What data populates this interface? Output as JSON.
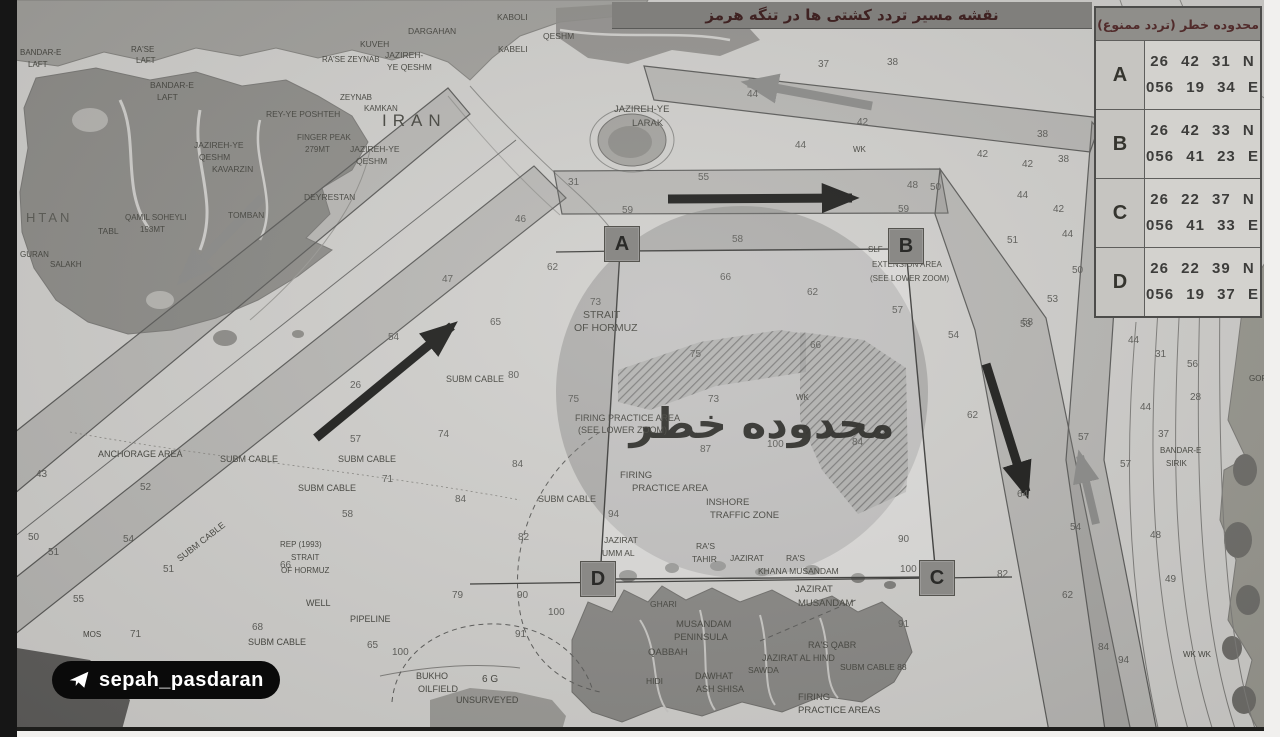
{
  "title": {
    "text": "نقشه مسیر تردد کشتی ها در تنگه هرمز"
  },
  "coords_table": {
    "header": "محدوده خطر (تردد ممنوع)",
    "rows": [
      {
        "point": "A",
        "lat": "26 42 31 N",
        "lon": "056 19 34 E"
      },
      {
        "point": "B",
        "lat": "26 42 33 N",
        "lon": "056 41 23 E"
      },
      {
        "point": "C",
        "lat": "26 22 37 N",
        "lon": "056 41 33 E"
      },
      {
        "point": "D",
        "lat": "26 22 39 N",
        "lon": "056 19 37 E"
      }
    ]
  },
  "watermark": {
    "label": "sepah_pasdaran",
    "icon": "telegram-plane-icon"
  },
  "map": {
    "danger_zone_label": "محدوده خطر",
    "corner_markers": [
      "A",
      "B",
      "C",
      "D"
    ],
    "arrows": [
      "inbound-northeast-arrow-black",
      "outbound-southwest-arrow-gray",
      "eastbound-arrow-black",
      "westbound-arrow-gray",
      "southbound-arrow-black",
      "northbound-arrow-gray"
    ],
    "colors": {
      "paper": "#cfcecb",
      "land_dark": "#8d8c88",
      "land_mid": "#a09f9b",
      "coast_right": "#98978f",
      "lane_line": "#5a5a58",
      "danger_fill": "#787876",
      "hatch": "#3f3f3d",
      "marker_bg": "#8a8986",
      "title_bar_bg": "#807f7c",
      "title_text": "#3f2222",
      "table_header_bg": "#8f8e8a",
      "table_text": "#3d3d3b",
      "watermark_bg": "#0a0a0a",
      "watermark_text": "#ffffff"
    },
    "place_labels": [
      {
        "t": "KABOLI",
        "x": 497,
        "y": 20,
        "fs": 8.5
      },
      {
        "t": "QESHM",
        "x": 543,
        "y": 39,
        "fs": 8.5
      },
      {
        "t": "KABELI",
        "x": 498,
        "y": 52,
        "fs": 8.5
      },
      {
        "t": "DARGAHAN",
        "x": 408,
        "y": 34,
        "fs": 8.5
      },
      {
        "t": "KUVEH",
        "x": 360,
        "y": 47,
        "fs": 8.5
      },
      {
        "t": "RA'SE ZEYNAB",
        "x": 322,
        "y": 62,
        "fs": 8
      },
      {
        "t": "JAZIREH-",
        "x": 385,
        "y": 58,
        "fs": 8.5
      },
      {
        "t": "YE QESHM",
        "x": 387,
        "y": 70,
        "fs": 8.5
      },
      {
        "t": "ZEYNAB",
        "x": 340,
        "y": 100,
        "fs": 8
      },
      {
        "t": "KAMKAN",
        "x": 364,
        "y": 111,
        "fs": 8
      },
      {
        "t": "REY-YE POSHTEH",
        "x": 266,
        "y": 117,
        "fs": 8.5
      },
      {
        "t": "RA'SE",
        "x": 131,
        "y": 52,
        "fs": 8
      },
      {
        "t": "LAFT",
        "x": 136,
        "y": 63,
        "fs": 8
      },
      {
        "t": "BANDAR-E",
        "x": 20,
        "y": 55,
        "fs": 8
      },
      {
        "t": "LAFT",
        "x": 28,
        "y": 67,
        "fs": 8
      },
      {
        "t": "BANDAR-E",
        "x": 150,
        "y": 88,
        "fs": 8.5
      },
      {
        "t": "LAFT",
        "x": 157,
        "y": 100,
        "fs": 8.5
      },
      {
        "t": "JAZIREH-YE",
        "x": 194,
        "y": 148,
        "fs": 8.5
      },
      {
        "t": "QESHM",
        "x": 199,
        "y": 160,
        "fs": 8.5
      },
      {
        "t": "KAVARZIN",
        "x": 212,
        "y": 172,
        "fs": 8.5
      },
      {
        "t": "FINGER PEAK",
        "x": 297,
        "y": 140,
        "fs": 8
      },
      {
        "t": "279MT",
        "x": 305,
        "y": 152,
        "fs": 8
      },
      {
        "t": "IRAN",
        "x": 382,
        "y": 126,
        "fs": 17,
        "ls": 6
      },
      {
        "t": "JAZIREH-YE",
        "x": 350,
        "y": 152,
        "fs": 8.5
      },
      {
        "t": "QESHM",
        "x": 356,
        "y": 164,
        "fs": 8.5
      },
      {
        "t": "DEYRESTAN",
        "x": 304,
        "y": 200,
        "fs": 8.5
      },
      {
        "t": "QAMIL SOHEYLI",
        "x": 125,
        "y": 220,
        "fs": 8
      },
      {
        "t": "198MT",
        "x": 140,
        "y": 232,
        "fs": 8
      },
      {
        "t": "TOMBAN",
        "x": 228,
        "y": 218,
        "fs": 8.5
      },
      {
        "t": "TABL",
        "x": 98,
        "y": 234,
        "fs": 8.5
      },
      {
        "t": "HTAN",
        "x": 26,
        "y": 222,
        "fs": 13,
        "ls": 3,
        "o": 0.7
      },
      {
        "t": "GURAN",
        "x": 20,
        "y": 257,
        "fs": 8
      },
      {
        "t": "SALAKH",
        "x": 50,
        "y": 267,
        "fs": 8
      },
      {
        "t": "JAZIREH-YE",
        "x": 614,
        "y": 112,
        "fs": 9.5
      },
      {
        "t": "LARAK",
        "x": 632,
        "y": 126,
        "fs": 9.5
      },
      {
        "t": "STRAIT",
        "x": 583,
        "y": 318,
        "fs": 10.5
      },
      {
        "t": "OF HORMUZ",
        "x": 574,
        "y": 331,
        "fs": 10.5
      },
      {
        "t": "SUBM CABLE",
        "x": 446,
        "y": 382,
        "fs": 9
      },
      {
        "t": "SUBM CABLE",
        "x": 220,
        "y": 462,
        "fs": 9
      },
      {
        "t": "SUBM CABLE",
        "x": 338,
        "y": 462,
        "fs": 9
      },
      {
        "t": "SUBM CABLE",
        "x": 298,
        "y": 491,
        "fs": 9
      },
      {
        "t": "SUBM CABLE",
        "x": 180,
        "y": 562,
        "fs": 9,
        "rot": -38
      },
      {
        "t": "SUBM CABLE",
        "x": 538,
        "y": 502,
        "fs": 9
      },
      {
        "t": "SUBM CABLE",
        "x": 248,
        "y": 645,
        "fs": 9
      },
      {
        "t": "ANCHORAGE AREA",
        "x": 98,
        "y": 457,
        "fs": 9
      },
      {
        "t": "REP (1993)",
        "x": 280,
        "y": 547,
        "fs": 8
      },
      {
        "t": "STRAIT",
        "x": 291,
        "y": 560,
        "fs": 8
      },
      {
        "t": "OF HORMUZ",
        "x": 281,
        "y": 573,
        "fs": 8
      },
      {
        "t": "WELL",
        "x": 306,
        "y": 606,
        "fs": 9
      },
      {
        "t": "PIPELINE",
        "x": 350,
        "y": 622,
        "fs": 9
      },
      {
        "t": "BUKHO",
        "x": 416,
        "y": 679,
        "fs": 9
      },
      {
        "t": "OILFIELD",
        "x": 418,
        "y": 692,
        "fs": 9
      },
      {
        "t": "6 G",
        "x": 482,
        "y": 682,
        "fs": 10
      },
      {
        "t": "UNSURVEYED",
        "x": 456,
        "y": 703,
        "fs": 9
      },
      {
        "t": "FIRING PRACTICE AREA",
        "x": 575,
        "y": 421,
        "fs": 9
      },
      {
        "t": "(SEE LOWER ZOOM)",
        "x": 578,
        "y": 433,
        "fs": 9
      },
      {
        "t": "FIRING",
        "x": 620,
        "y": 478,
        "fs": 9.5
      },
      {
        "t": "PRACTICE AREA",
        "x": 632,
        "y": 491,
        "fs": 9.5
      },
      {
        "t": "INSHORE",
        "x": 706,
        "y": 505,
        "fs": 9.5
      },
      {
        "t": "TRAFFIC ZONE",
        "x": 710,
        "y": 518,
        "fs": 9.5
      },
      {
        "t": "JAZIRAT",
        "x": 604,
        "y": 543,
        "fs": 8.5
      },
      {
        "t": "UMM AL",
        "x": 602,
        "y": 556,
        "fs": 8.5
      },
      {
        "t": "RA'S",
        "x": 696,
        "y": 549,
        "fs": 8.5
      },
      {
        "t": "TAHIR",
        "x": 692,
        "y": 562,
        "fs": 8.5
      },
      {
        "t": "JAZIRAT",
        "x": 730,
        "y": 561,
        "fs": 8.5
      },
      {
        "t": "RA'S",
        "x": 786,
        "y": 561,
        "fs": 8.5
      },
      {
        "t": "KHANA MUSANDAM",
        "x": 758,
        "y": 574,
        "fs": 8.5
      },
      {
        "t": "JAZIRAT",
        "x": 795,
        "y": 592,
        "fs": 9.5
      },
      {
        "t": "MUSANDAM",
        "x": 798,
        "y": 606,
        "fs": 9.5
      },
      {
        "t": "GHARI",
        "x": 650,
        "y": 607,
        "fs": 8.5
      },
      {
        "t": "MUSANDAM",
        "x": 676,
        "y": 627,
        "fs": 9.5
      },
      {
        "t": "PENINSULA",
        "x": 674,
        "y": 640,
        "fs": 9.5
      },
      {
        "t": "QABBAH",
        "x": 648,
        "y": 655,
        "fs": 9.5
      },
      {
        "t": "RA'S QABR",
        "x": 808,
        "y": 648,
        "fs": 9
      },
      {
        "t": "JAZIRAT AL HIND",
        "x": 762,
        "y": 661,
        "fs": 9
      },
      {
        "t": "SAWDA",
        "x": 748,
        "y": 673,
        "fs": 8.5
      },
      {
        "t": "DAWHAT",
        "x": 695,
        "y": 679,
        "fs": 9
      },
      {
        "t": "ASH SHISA",
        "x": 696,
        "y": 692,
        "fs": 9
      },
      {
        "t": "HIDI",
        "x": 646,
        "y": 684,
        "fs": 8.5
      },
      {
        "t": "SUBM CABLE 88",
        "x": 840,
        "y": 670,
        "fs": 8.5
      },
      {
        "t": "FIRING",
        "x": 798,
        "y": 700,
        "fs": 9.5
      },
      {
        "t": "PRACTICE AREAS",
        "x": 798,
        "y": 713,
        "fs": 9.5
      },
      {
        "t": "SLF",
        "x": 868,
        "y": 252,
        "fs": 8
      },
      {
        "t": "EXTENSION AREA",
        "x": 872,
        "y": 267,
        "fs": 8
      },
      {
        "t": "(SEE LOWER ZOOM)",
        "x": 870,
        "y": 281,
        "fs": 8
      },
      {
        "t": "BANDAR-E",
        "x": 1160,
        "y": 453,
        "fs": 8
      },
      {
        "t": "SIRIK",
        "x": 1166,
        "y": 466,
        "fs": 8
      },
      {
        "t": "GOR",
        "x": 1249,
        "y": 381,
        "fs": 8
      },
      {
        "t": "WK",
        "x": 853,
        "y": 152,
        "fs": 8
      },
      {
        "t": "WK",
        "x": 796,
        "y": 400,
        "fs": 8
      },
      {
        "t": "WK WK",
        "x": 1183,
        "y": 657,
        "fs": 8
      },
      {
        "t": "MOS",
        "x": 83,
        "y": 637,
        "fs": 8
      }
    ],
    "depth_labels": [
      {
        "t": "37",
        "x": 818,
        "y": 67
      },
      {
        "t": "38",
        "x": 887,
        "y": 65
      },
      {
        "t": "44",
        "x": 747,
        "y": 97
      },
      {
        "t": "42",
        "x": 857,
        "y": 125
      },
      {
        "t": "44",
        "x": 795,
        "y": 148
      },
      {
        "t": "42",
        "x": 977,
        "y": 157
      },
      {
        "t": "38",
        "x": 1037,
        "y": 137
      },
      {
        "t": "38",
        "x": 1058,
        "y": 162
      },
      {
        "t": "42",
        "x": 1022,
        "y": 167
      },
      {
        "t": "44",
        "x": 1017,
        "y": 198
      },
      {
        "t": "42",
        "x": 1053,
        "y": 212
      },
      {
        "t": "44",
        "x": 1062,
        "y": 237
      },
      {
        "t": "51",
        "x": 1007,
        "y": 243
      },
      {
        "t": "50",
        "x": 1072,
        "y": 273
      },
      {
        "t": "53",
        "x": 1047,
        "y": 302
      },
      {
        "t": "53",
        "x": 1020,
        "y": 327
      },
      {
        "t": "57",
        "x": 892,
        "y": 313
      },
      {
        "t": "54",
        "x": 948,
        "y": 338
      },
      {
        "t": "48",
        "x": 907,
        "y": 188
      },
      {
        "t": "50",
        "x": 930,
        "y": 190
      },
      {
        "t": "59",
        "x": 898,
        "y": 212
      },
      {
        "t": "55",
        "x": 698,
        "y": 180
      },
      {
        "t": "59",
        "x": 622,
        "y": 213
      },
      {
        "t": "58",
        "x": 732,
        "y": 242
      },
      {
        "t": "44",
        "x": 1128,
        "y": 343
      },
      {
        "t": "31",
        "x": 1155,
        "y": 357
      },
      {
        "t": "56",
        "x": 1187,
        "y": 367
      },
      {
        "t": "28",
        "x": 1190,
        "y": 400
      },
      {
        "t": "44",
        "x": 1140,
        "y": 410
      },
      {
        "t": "37",
        "x": 1158,
        "y": 437
      },
      {
        "t": "57",
        "x": 1078,
        "y": 440
      },
      {
        "t": "57",
        "x": 1120,
        "y": 467
      },
      {
        "t": "54",
        "x": 1070,
        "y": 530
      },
      {
        "t": "48",
        "x": 1150,
        "y": 538
      },
      {
        "t": "49",
        "x": 1165,
        "y": 582
      },
      {
        "t": "62",
        "x": 1062,
        "y": 598
      },
      {
        "t": "84",
        "x": 1098,
        "y": 650
      },
      {
        "t": "94",
        "x": 1118,
        "y": 663
      },
      {
        "t": "58",
        "x": 1022,
        "y": 325
      },
      {
        "t": "62",
        "x": 967,
        "y": 418
      },
      {
        "t": "64",
        "x": 1017,
        "y": 497
      },
      {
        "t": "31",
        "x": 568,
        "y": 185
      },
      {
        "t": "46",
        "x": 515,
        "y": 222
      },
      {
        "t": "62",
        "x": 547,
        "y": 270
      },
      {
        "t": "65",
        "x": 490,
        "y": 325
      },
      {
        "t": "47",
        "x": 442,
        "y": 282
      },
      {
        "t": "54",
        "x": 388,
        "y": 340
      },
      {
        "t": "26",
        "x": 350,
        "y": 388
      },
      {
        "t": "80",
        "x": 508,
        "y": 378
      },
      {
        "t": "75",
        "x": 568,
        "y": 402
      },
      {
        "t": "73",
        "x": 590,
        "y": 305
      },
      {
        "t": "66",
        "x": 720,
        "y": 280
      },
      {
        "t": "62",
        "x": 807,
        "y": 295
      },
      {
        "t": "75",
        "x": 690,
        "y": 357
      },
      {
        "t": "66",
        "x": 810,
        "y": 348
      },
      {
        "t": "73",
        "x": 708,
        "y": 402
      },
      {
        "t": "100",
        "x": 767,
        "y": 447
      },
      {
        "t": "84",
        "x": 852,
        "y": 445
      },
      {
        "t": "87",
        "x": 700,
        "y": 452
      },
      {
        "t": "94",
        "x": 608,
        "y": 517
      },
      {
        "t": "82",
        "x": 518,
        "y": 540
      },
      {
        "t": "90",
        "x": 517,
        "y": 598
      },
      {
        "t": "100",
        "x": 548,
        "y": 615
      },
      {
        "t": "91",
        "x": 515,
        "y": 637
      },
      {
        "t": "100",
        "x": 392,
        "y": 655
      },
      {
        "t": "65",
        "x": 367,
        "y": 648
      },
      {
        "t": "74",
        "x": 438,
        "y": 437
      },
      {
        "t": "84",
        "x": 512,
        "y": 467
      },
      {
        "t": "84",
        "x": 455,
        "y": 502
      },
      {
        "t": "71",
        "x": 382,
        "y": 482
      },
      {
        "t": "58",
        "x": 342,
        "y": 517
      },
      {
        "t": "57",
        "x": 350,
        "y": 442
      },
      {
        "t": "79",
        "x": 452,
        "y": 598
      },
      {
        "t": "43",
        "x": 36,
        "y": 477
      },
      {
        "t": "52",
        "x": 140,
        "y": 490
      },
      {
        "t": "50",
        "x": 28,
        "y": 540
      },
      {
        "t": "51",
        "x": 48,
        "y": 555
      },
      {
        "t": "54",
        "x": 123,
        "y": 542
      },
      {
        "t": "55",
        "x": 73,
        "y": 602
      },
      {
        "t": "51",
        "x": 163,
        "y": 572
      },
      {
        "t": "71",
        "x": 130,
        "y": 637
      },
      {
        "t": "68",
        "x": 252,
        "y": 630
      },
      {
        "t": "66",
        "x": 280,
        "y": 568
      },
      {
        "t": "90",
        "x": 898,
        "y": 542
      },
      {
        "t": "100",
        "x": 900,
        "y": 572
      },
      {
        "t": "91",
        "x": 898,
        "y": 627
      },
      {
        "t": "82",
        "x": 997,
        "y": 577
      }
    ]
  }
}
